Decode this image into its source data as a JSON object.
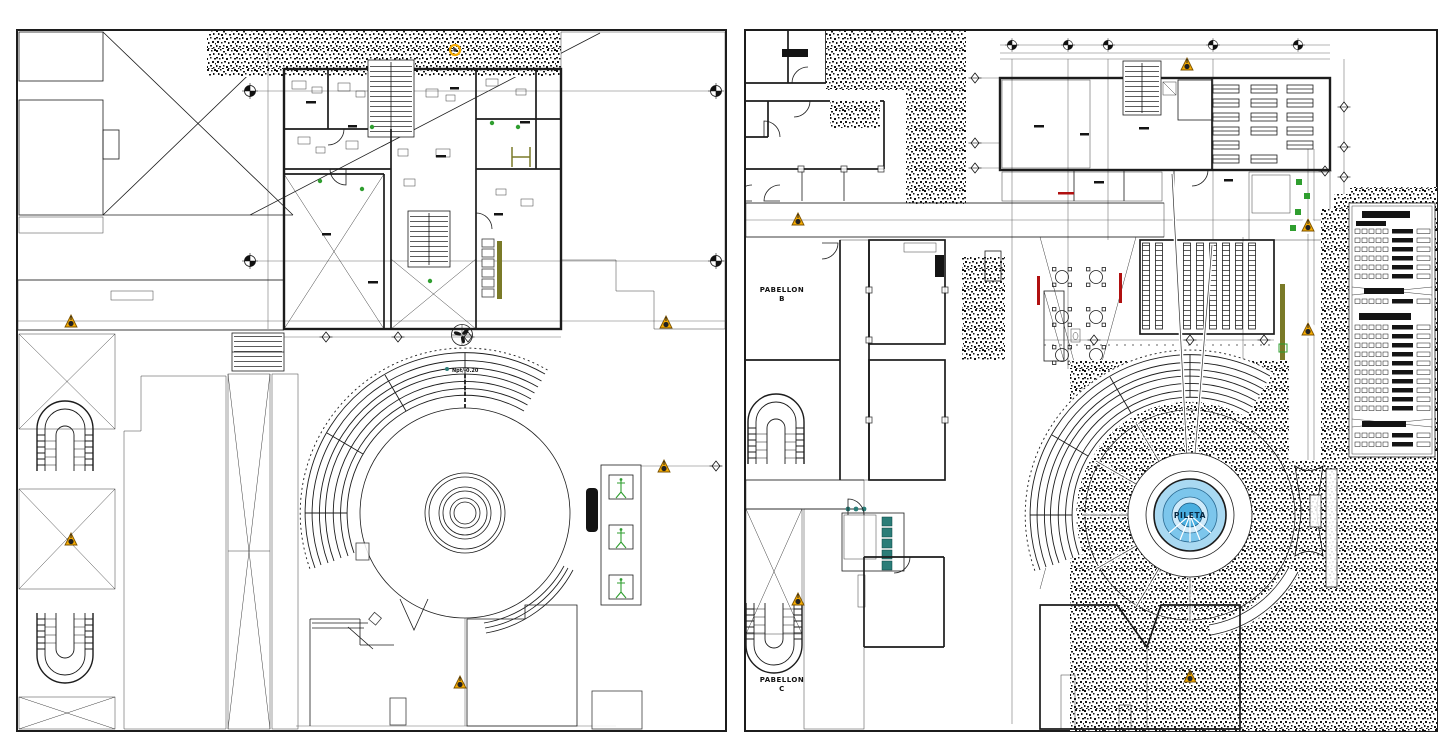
{
  "page": {
    "background": "#ffffff",
    "panel_count": 2
  },
  "colors": {
    "ink": "#1c1c1c",
    "marker_orange": "#f6ab00",
    "marker_orange_dark": "#7a5200",
    "plant_green": "#2f9e2f",
    "fixture_teal": "#2b7d78",
    "olive": "#7a7a28",
    "accent_red": "#b01010",
    "fountain_light": "#a9d9f2",
    "fountain_mid": "#7cc6ec",
    "fountain_core": "#49aee0",
    "gray_block": "#777777"
  },
  "panel_left": {
    "id": "floor-plan",
    "labels": {
      "plaza_level": "Npt/-0.20"
    }
  },
  "panel_right": {
    "id": "site-plan",
    "labels": {
      "pabellon_b_line1": "PABELLON",
      "pabellon_b_line2": "B",
      "pabellon_c_line1": "PABELLON",
      "pabellon_c_line2": "C",
      "fountain": "PILETA"
    }
  },
  "icons": {
    "level_marker": "survey-cone-icon",
    "axis_target": "axis-target-icon",
    "axis_diamond": "axis-diamond-icon",
    "bench": "garden-bench-icon",
    "fan": "extractor-fan-icon",
    "plant": "plant-icon",
    "stair": "horseshoe-stair-icon"
  }
}
